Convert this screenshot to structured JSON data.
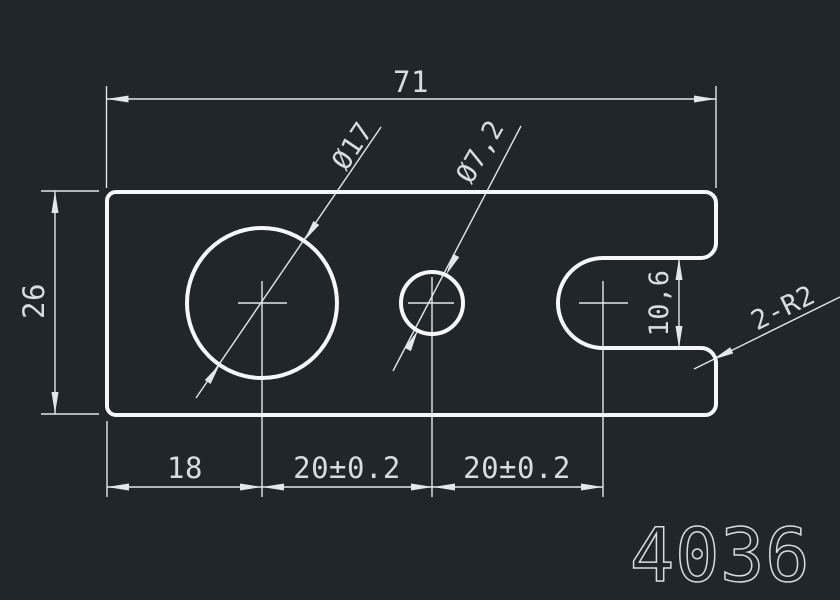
{
  "drawing": {
    "background_color": "#21262b",
    "colors": {
      "outline": "#f6f7f8",
      "dimension": "#e4e7e9",
      "text": "#d9dcde"
    },
    "part_number": "4036",
    "dims": {
      "overall_width": "71",
      "overall_height": "26",
      "large_hole": "Ø17",
      "small_hole": "Ø7,2",
      "slot_width": "10,6",
      "edge_to_large_hole": "18",
      "large_to_small": "20±0.2",
      "small_to_slot": "20±0.2",
      "slot_radii": "2-R2"
    }
  }
}
